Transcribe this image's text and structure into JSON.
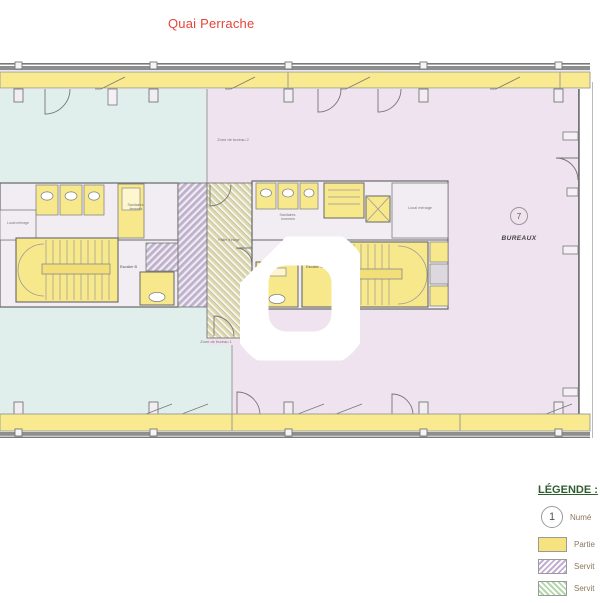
{
  "title": {
    "street_label": "Quai Perrache"
  },
  "plan": {
    "zones": {
      "zone1_label": "Zone de bureau 1",
      "zone2_label": "Zone de bureau 2",
      "bureaux_number": "7",
      "bureaux_label": "BUREAUX"
    },
    "rooms": {
      "sanitaires_femmes_l1": "Sanitaires",
      "sanitaires_femmes_l2": "femmes",
      "sanitaires_hommes_l1": "Sanitaires",
      "sanitaires_hommes_l2": "hommes",
      "local_menage_left": "Local ménage",
      "local_menage_right": "Local ménage",
      "escalier_b": "Escalier B",
      "escalier_c": "Escalier C",
      "palier": "Palier d'étage"
    },
    "colors": {
      "accent_red": "#e8433a",
      "zone_left_teal": "#e1efec",
      "zone_right_pink": "#efe3ef",
      "facade_yellow": "#f9e98f",
      "room_yellow": "#f8e88c",
      "wall_gray": "#666666"
    }
  },
  "legend": {
    "title": "LÉGENDE :",
    "items": [
      {
        "symbol": "circled-number",
        "number": "1",
        "label": "Numé"
      },
      {
        "symbol": "yellow-swatch",
        "label": "Partie"
      },
      {
        "symbol": "violet-hatch-swatch",
        "label": "Servit"
      },
      {
        "symbol": "green-hatch-swatch",
        "label": "Servit"
      }
    ]
  }
}
